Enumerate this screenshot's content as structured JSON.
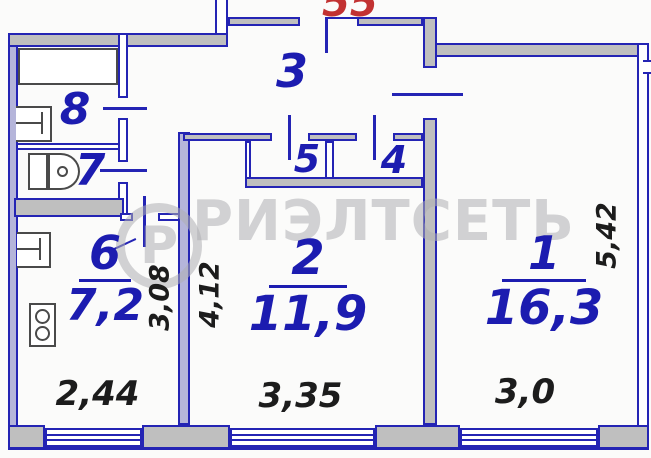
{
  "floorplan": {
    "apartment_number": "55",
    "watermark": {
      "text": "РИЭЛТСЕТЬ",
      "logo_letter": "Р"
    },
    "rooms": {
      "r1": {
        "number": "1",
        "area": "16,3"
      },
      "r2": {
        "number": "2",
        "area": "11,9"
      },
      "r3": {
        "number": "3"
      },
      "r4": {
        "number": "4"
      },
      "r5": {
        "number": "5"
      },
      "r6": {
        "number": "6",
        "area": "7,2"
      },
      "r7": {
        "number": "7"
      },
      "r8": {
        "number": "8"
      }
    },
    "dimensions": {
      "kitchen_width": "2,44",
      "kitchen_depth": "3,08",
      "room2_width": "3,35",
      "room2_depth": "4,12",
      "room1_width": "3,0",
      "room1_depth": "5,42"
    },
    "colors": {
      "wall_line": "#2424b4",
      "wall_fill_gray": "#bfbfbf",
      "wall_fill_light": "#b5b5da",
      "label_blue": "#1c1cb0",
      "dimension_black": "#1c1c1c",
      "apartment_red": "#c23232",
      "watermark_gray": "#afafb2"
    }
  }
}
